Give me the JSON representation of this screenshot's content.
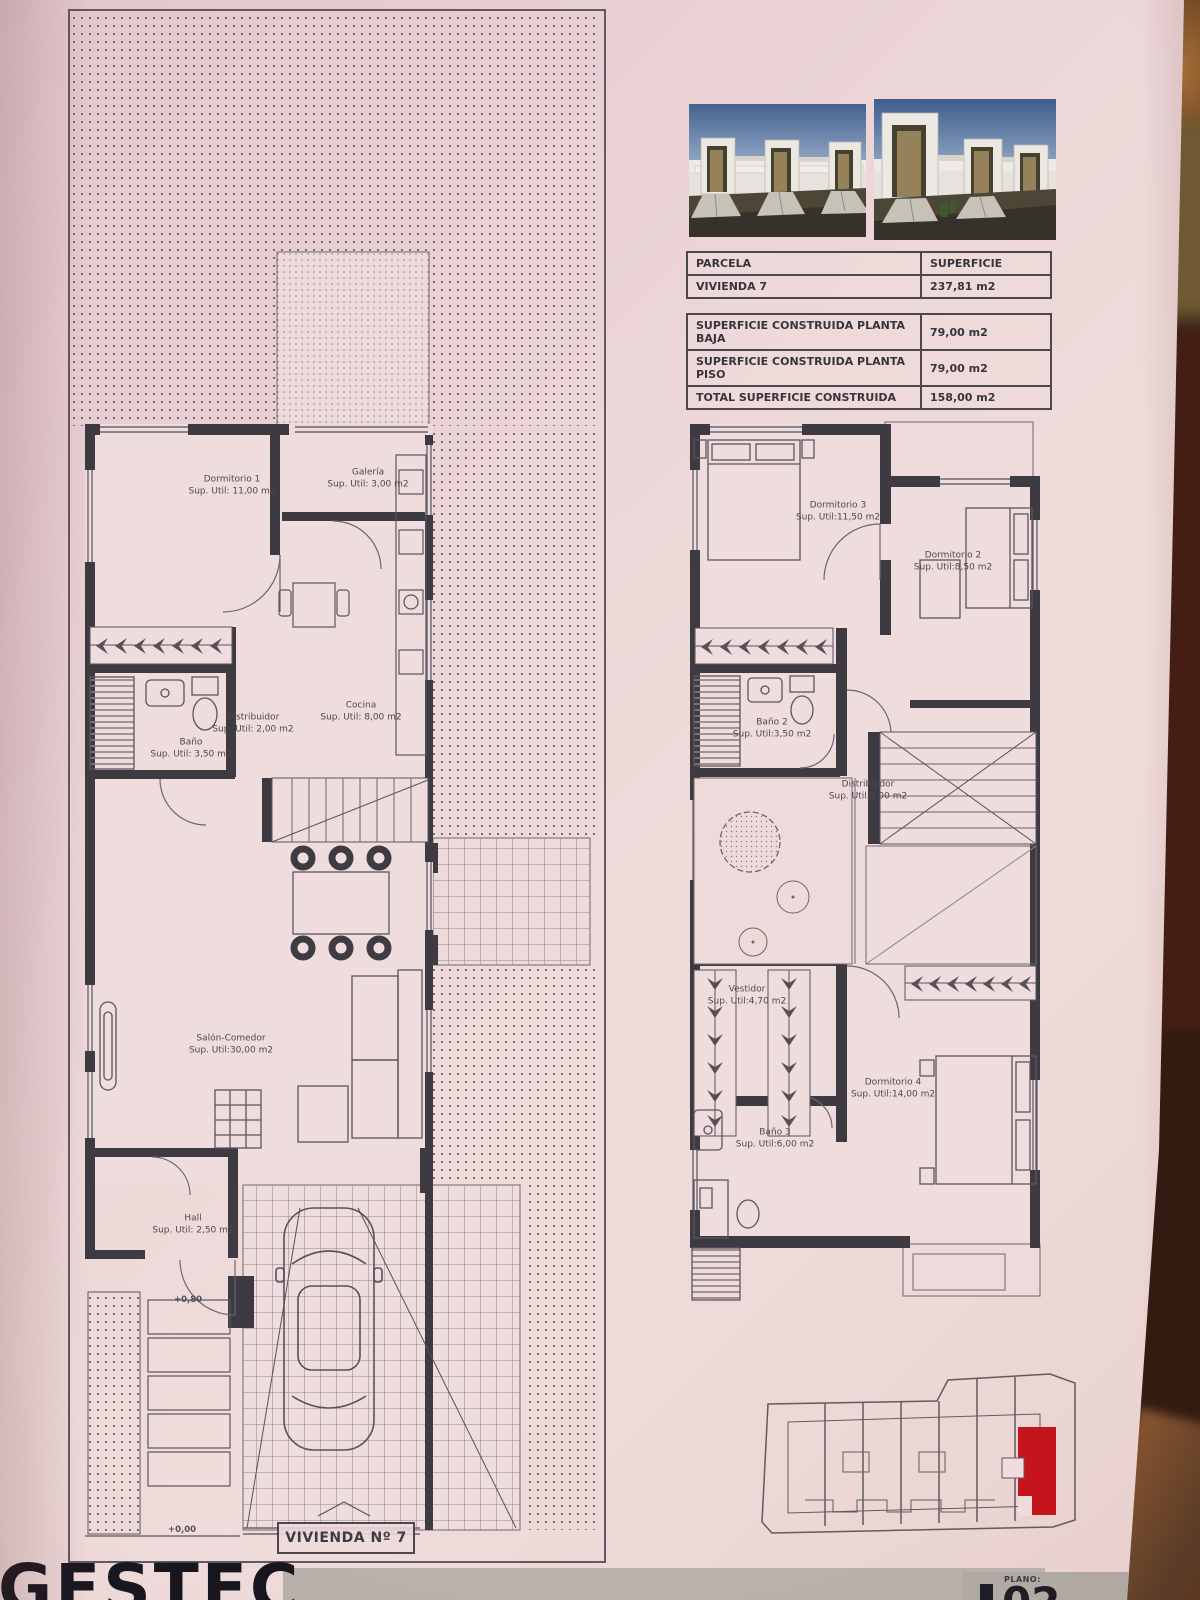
{
  "colors": {
    "paper": "#ecd5d7",
    "wall": "#3d3a42",
    "accent_red": "#c6141c"
  },
  "parcela_table": {
    "header": [
      "PARCELA",
      "SUPERFICIE"
    ],
    "row": [
      "VIVIENDA 7",
      "237,81 m2"
    ]
  },
  "surface_table": {
    "rows": [
      {
        "label": "SUPERFICIE CONSTRUIDA PLANTA BAJA",
        "value": "79,00 m2"
      },
      {
        "label": "SUPERFICIE CONSTRUIDA PLANTA PISO",
        "value": "79,00 m2"
      },
      {
        "label": "TOTAL SUPERFICIE CONSTRUIDA",
        "value": "158,00 m2"
      }
    ]
  },
  "ground_floor": {
    "rooms": [
      {
        "name": "Dormitorio 1",
        "area": "Sup. Util: 11,00 m2"
      },
      {
        "name": "Galería",
        "area": "Sup. Util: 3,00 m2"
      },
      {
        "name": "Distribuidor",
        "area": "Sup. Util: 2,00 m2"
      },
      {
        "name": "Cocina",
        "area": "Sup. Util: 8,00 m2"
      },
      {
        "name": "Baño",
        "area": "Sup. Util: 3,50 m2"
      },
      {
        "name": "Salón-Comedor",
        "area": "Sup. Util:30,00 m2"
      },
      {
        "name": "Hall",
        "area": "Sup. Util: 2,50 m2"
      }
    ],
    "level_upper": "+0,80",
    "level_entry": "+0,00",
    "title": "VIVIENDA Nº 7"
  },
  "upper_floor": {
    "rooms": [
      {
        "name": "Dormitorio 3",
        "area": "Sup. Util:11,50 m2"
      },
      {
        "name": "Dormitorio 2",
        "area": "Sup. Util:8,50 m2"
      },
      {
        "name": "Baño 2",
        "area": "Sup. Util:3,50 m2"
      },
      {
        "name": "Distribuidor",
        "area": "Sup. Util:5,00 m2"
      },
      {
        "name": "Vestidor",
        "area": "Sup. Util:4,70 m2"
      },
      {
        "name": "Dormitorio 4",
        "area": "Sup. Util:14,00 m2"
      },
      {
        "name": "Baño 3",
        "area": "Sup. Util:6,00 m2"
      }
    ]
  },
  "title_block": {
    "logo": "GESTEC",
    "plano_label": "PLANO:",
    "plano_number": "02"
  }
}
